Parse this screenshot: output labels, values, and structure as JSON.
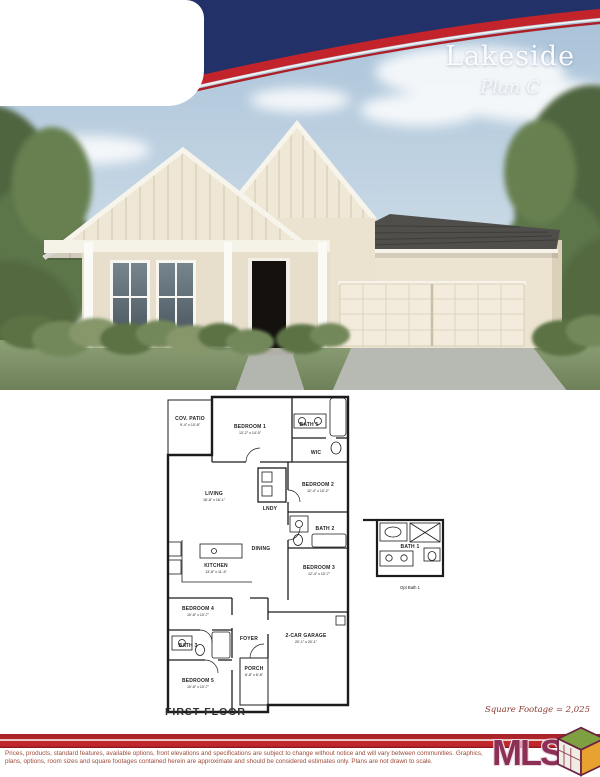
{
  "header": {
    "title": "Lakeside",
    "subtitle": "Plan C"
  },
  "floor_plan": {
    "title": "FIRST FLOOR",
    "square_footage": "Square Footage = 2,025",
    "rooms": {
      "cov_patio": {
        "label": "COV. PATIO",
        "dims": "9'-4\" x 10'-8\""
      },
      "bedroom1": {
        "label": "BEDROOM 1",
        "dims": "13'-2\" x 14'-0\""
      },
      "bath1": {
        "label": "BATH 1",
        "dims": ""
      },
      "wic": {
        "label": "WIC",
        "dims": ""
      },
      "living": {
        "label": "LIVING",
        "dims": "16'-8\" x 16'-1\""
      },
      "lndy": {
        "label": "LNDY",
        "dims": ""
      },
      "bedroom2": {
        "label": "BEDROOM 2",
        "dims": "12'-4\" x 10'-2\""
      },
      "bath2": {
        "label": "BATH 2",
        "dims": ""
      },
      "dining": {
        "label": "DINING",
        "dims": ""
      },
      "kitchen": {
        "label": "KITCHEN",
        "dims": "13'-8\" x 11'-4\""
      },
      "bedroom3": {
        "label": "BEDROOM 3",
        "dims": "12'-4\" x 10'-7\""
      },
      "bedroom4": {
        "label": "BEDROOM 4",
        "dims": "10'-8\" x 10'-7\""
      },
      "bath3": {
        "label": "BATH 3",
        "dims": ""
      },
      "foyer": {
        "label": "FOYER",
        "dims": ""
      },
      "bedroom5": {
        "label": "BEDROOM 5",
        "dims": "10'-8\" x 10'-7\""
      },
      "garage": {
        "label": "2-CAR GARAGE",
        "dims": "20'-1\" x 20'-1\""
      },
      "porch": {
        "label": "PORCH",
        "dims": "6'-8\" x 6'-8\""
      }
    },
    "optional_bath": {
      "label": "BATH 1",
      "caption": "Opt Bath 1"
    }
  },
  "footer": {
    "disclaimer_line1": "Prices, products, standard features, available options, front elevations and specifications are subject to change without notice and will vary between communities. Graphics,",
    "disclaimer_line2": "plans, options, room sizes and square footages contained herein are approximate and should be considered estimates only. Plans are not drawn to scale.",
    "mls_logo": "MLS"
  },
  "colors": {
    "banner_navy": "#223268",
    "banner_red": "#c3232a",
    "footer_band_red": "#c1272d",
    "disclaimer_text": "#9c4a38",
    "mls_maroon": "#8d2f55",
    "sqft_text": "#8a3a30"
  }
}
